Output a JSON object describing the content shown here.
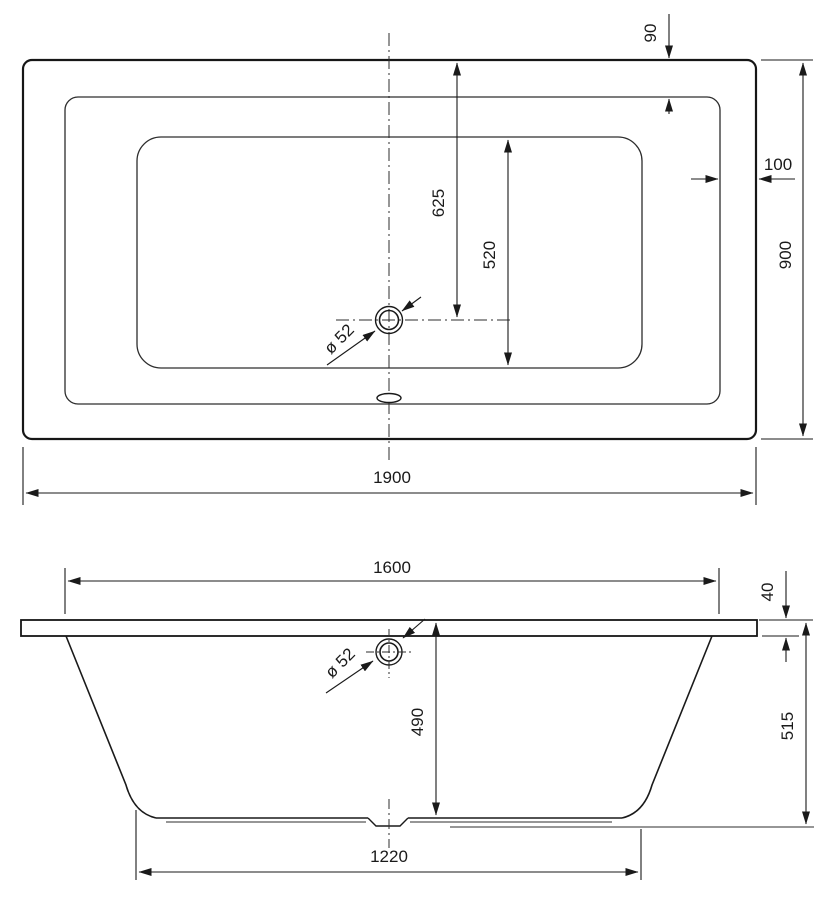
{
  "drawing": {
    "type": "technical-drawing",
    "subject": "rectangular bathtub, plan view and front elevation",
    "units": "mm",
    "line_color": "#1a1a1a",
    "background_color": "#ffffff",
    "top_view": {
      "overall_length": "1900",
      "overall_width": "900",
      "rim_offset_top": "90",
      "rim_offset_side": "100",
      "drain_offset_from_edge": "625",
      "inner_basin_width": "520",
      "drain_diameter": "ø 52"
    },
    "side_view": {
      "basin_top_length": "1600",
      "rim_thickness": "40",
      "total_height": "515",
      "shell_height": "490",
      "base_length": "1220",
      "drain_diameter": "ø 52"
    }
  }
}
